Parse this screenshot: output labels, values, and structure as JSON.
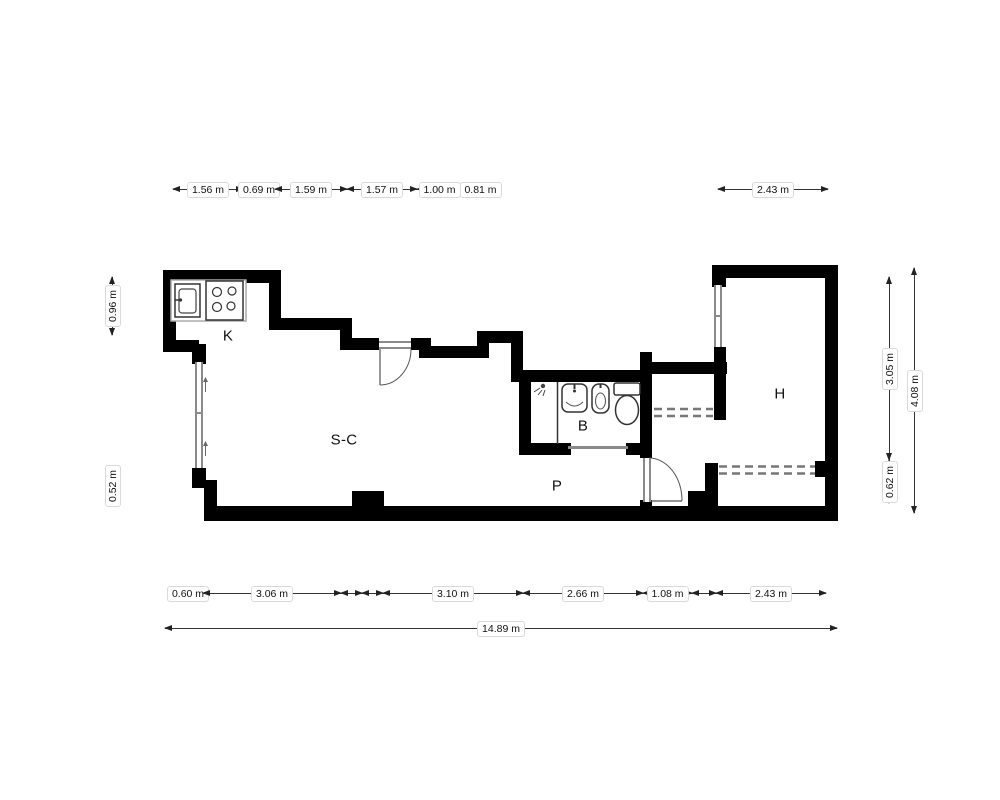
{
  "plan_type": "apartment-floor-plan",
  "rooms": {
    "kitchen": {
      "label": "K"
    },
    "living": {
      "label": "S-C"
    },
    "bathroom": {
      "label": "B"
    },
    "hall": {
      "label": "P"
    },
    "bedroom": {
      "label": "H"
    }
  },
  "dims": {
    "top": [
      "1.56 m",
      "0.69 m",
      "1.59 m",
      "1.57 m",
      "1.00 m",
      "0.81 m",
      "2.43 m"
    ],
    "bottom": [
      "0.60 m",
      "3.06 m",
      "3.10 m",
      "2.66 m",
      "1.08 m",
      "2.43 m"
    ],
    "total": "14.89 m",
    "left": [
      "0.96 m",
      "0.52 m"
    ],
    "right": [
      "3.05 m",
      "0.62 m",
      "4.08 m"
    ]
  },
  "fixtures": [
    "sink-icon",
    "stove-icon",
    "shower-icon",
    "washbasin-icon",
    "bidet-icon",
    "toilet-icon",
    "wardrobe-dashed-front",
    "door-swing"
  ],
  "colors": {
    "wall": "#000000",
    "window_line": "#8a8a8a",
    "wardrobe_dash": "#777777",
    "dimension_line": "#333333",
    "label_border": "#d9d9d9",
    "text": "#111111",
    "background": "#ffffff"
  }
}
